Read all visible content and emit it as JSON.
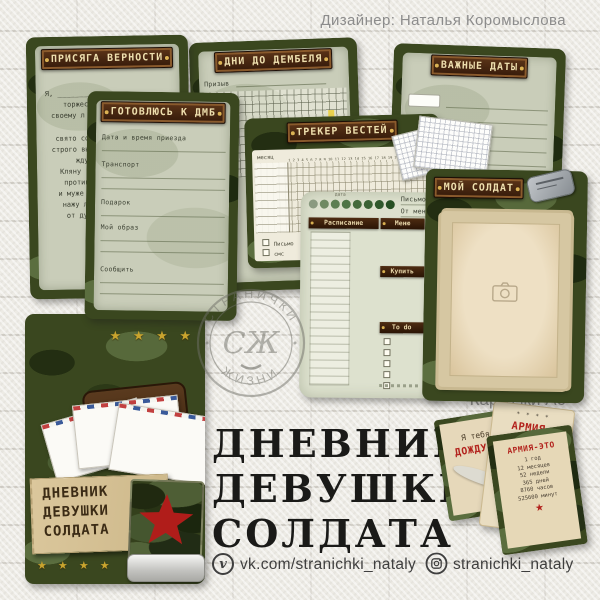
{
  "header": {
    "designer_credit": "Дизайнер: Наталья Коромыслова"
  },
  "cards": {
    "oath": {
      "title": "ПРИСЯГА ВЕРНОСТИ",
      "lines": [
        "Я, _______________",
        "торжест",
        "своему л",
        "свято со",
        "строго вы",
        "жду",
        "Кляну",
        "против",
        "и муже",
        "нажу ли",
        "от дур"
      ]
    },
    "prep": {
      "title": "ГОТОВЛЮСЬ К ДМБ",
      "labels": [
        "Дата и время приезда",
        "Транспорт",
        "Подарок",
        "Мой образ",
        "Сообщить",
        "Не забыть!"
      ]
    },
    "countdown": {
      "title": "ДНИ ДО ДЕМБЕЛЯ",
      "field_label": "Призыв"
    },
    "tracker": {
      "title": "ТРЕКЕР ВЕСТЕЙ",
      "month_label": "месяц",
      "days": "1 2 3 4 5 6 7 8 9 10 11 12 13 14 15 16 17 18 19 20 21 22 23 24 25 26 27 28 29 30 31",
      "legend": [
        "Письмо",
        "смс"
      ]
    },
    "planner": {
      "date_label": "дата",
      "letter_label": "Письмо",
      "from_me_label": "От меня",
      "banners": [
        "Расписание",
        "Меню",
        "Купить",
        "To do"
      ]
    },
    "dates": {
      "title": "ВАЖНЫЕ ДАТЫ"
    },
    "soldier": {
      "title": "МОЙ СОЛДАТ"
    }
  },
  "cover": {
    "title_lines": [
      "ДНЕВНИК",
      "ДЕВУШКИ",
      "СОЛДАТА"
    ]
  },
  "main_title": {
    "lines": [
      "ДНЕВНИК",
      "ДЕВУШКИ",
      "СОЛДАТА"
    ]
  },
  "a6": {
    "label": "Карточки А6",
    "card1": {
      "top": "Я тебя",
      "title": "ДОЖДУСЬ"
    },
    "card2": {
      "stars": "✶ ✶ ✶ ✶",
      "title": "АРМИЯ_",
      "lines": [
        "она не",
        "разбивает,",
        "она испытывает"
      ],
      "highlight": "ЧУВСТВА"
    },
    "card3": {
      "title": "АРМИЯ-ЭТО",
      "lines": [
        "1 год",
        "12 месяцев",
        "52 недели",
        "365 дней",
        "8760 часов",
        "525600 минут"
      ],
      "star": "★"
    }
  },
  "stamp": {
    "arc_top": "СТРАНИЧКИ",
    "arc_bottom": "ЖИЗНИ",
    "monogram": "СЖ"
  },
  "footer": {
    "vk_icon_glyph": "v",
    "vk_handle": "vk.com/stranichki_nataly",
    "instagram_handle": "stranichki_nataly"
  },
  "colors": {
    "camo_base": "#3a471f",
    "plaque_brown": "#351a0a",
    "star_red": "#c3201d",
    "gold": "#c9a42e"
  }
}
